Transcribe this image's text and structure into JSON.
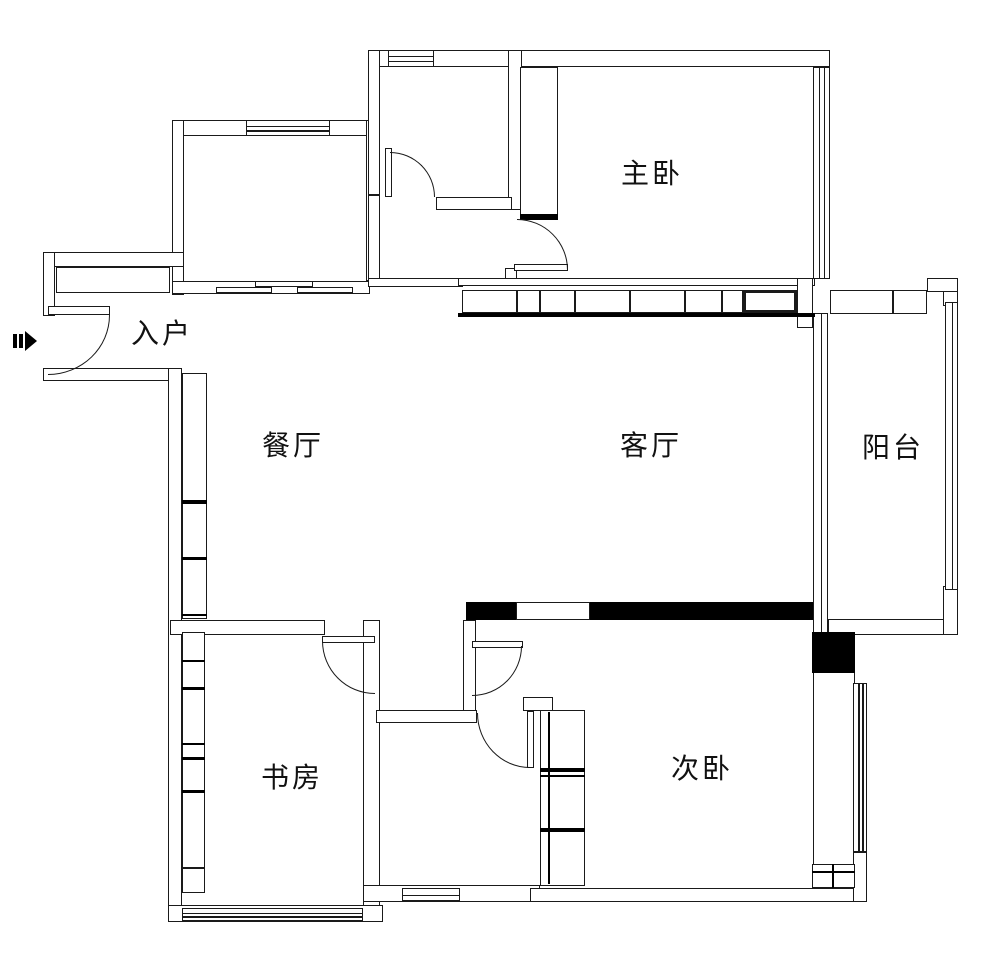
{
  "canvas": {
    "width": 989,
    "height": 970,
    "background_color": "#ffffff",
    "line_color": "#1a1a1a",
    "solid_fill_color": "#000000"
  },
  "rooms": {
    "entry": {
      "label": "入户"
    },
    "master_bedroom": {
      "label": "主卧"
    },
    "dining_room": {
      "label": "餐厅"
    },
    "living_room": {
      "label": "客厅"
    },
    "balcony": {
      "label": "阳台"
    },
    "study": {
      "label": "书房"
    },
    "second_bedroom": {
      "label": "次卧"
    }
  },
  "floorplan": {
    "walls": [
      [
        368,
        50,
        462,
        17
      ],
      [
        172,
        120,
        198,
        16
      ],
      [
        172,
        120,
        12,
        175
      ],
      [
        366,
        120,
        14,
        161
      ],
      [
        172,
        281,
        198,
        13
      ],
      [
        43,
        252,
        141,
        15
      ],
      [
        43,
        252,
        12,
        64
      ],
      [
        43,
        368,
        139,
        13
      ],
      [
        168,
        368,
        14,
        554
      ],
      [
        368,
        50,
        12,
        145
      ],
      [
        368,
        195,
        12,
        86
      ],
      [
        368,
        278,
        95,
        9
      ],
      [
        508,
        50,
        14,
        160
      ],
      [
        436,
        197,
        76,
        13
      ],
      [
        505,
        268,
        12,
        12
      ],
      [
        458,
        278,
        357,
        8
      ],
      [
        797,
        278,
        16,
        50
      ],
      [
        828,
        619,
        130,
        16
      ],
      [
        943,
        282,
        15,
        24
      ],
      [
        943,
        586,
        15,
        49
      ],
      [
        927,
        278,
        31,
        14
      ],
      [
        170,
        620,
        155,
        15
      ],
      [
        363,
        620,
        17,
        302
      ],
      [
        463,
        620,
        13,
        100
      ],
      [
        376,
        710,
        101,
        13
      ],
      [
        523,
        697,
        30,
        14
      ],
      [
        363,
        885,
        177,
        17
      ],
      [
        168,
        905,
        215,
        17
      ],
      [
        530,
        888,
        337,
        14
      ],
      [
        813,
        672,
        42,
        194
      ],
      [
        853,
        852,
        14,
        50
      ],
      [
        56,
        267,
        114,
        26
      ],
      [
        520,
        67,
        38,
        148
      ],
      [
        182,
        373,
        25,
        246
      ],
      [
        182,
        632,
        23,
        236
      ],
      [
        182,
        868,
        23,
        25
      ],
      [
        540,
        710,
        45,
        176
      ],
      [
        812,
        864,
        43,
        24
      ],
      [
        255,
        281,
        58,
        6
      ],
      [
        216,
        287,
        56,
        6
      ],
      [
        297,
        287,
        56,
        6
      ]
    ],
    "solids": [
      [
        466,
        602,
        50,
        18
      ],
      [
        590,
        602,
        223,
        18
      ],
      [
        812,
        632,
        43,
        41
      ],
      [
        520,
        214,
        38,
        6
      ],
      [
        458,
        313,
        357,
        4
      ],
      [
        182,
        500,
        25,
        4
      ],
      [
        182,
        557,
        25,
        3
      ],
      [
        182,
        614,
        25,
        2
      ],
      [
        182,
        660,
        23,
        2
      ],
      [
        182,
        687,
        23,
        3
      ],
      [
        182,
        743,
        23,
        2
      ],
      [
        182,
        757,
        23,
        3
      ],
      [
        182,
        790,
        23,
        3
      ],
      [
        540,
        768,
        45,
        4
      ],
      [
        540,
        775,
        45,
        2
      ],
      [
        540,
        828,
        45,
        4
      ],
      [
        548,
        712,
        2,
        172
      ],
      [
        832,
        864,
        2,
        24
      ],
      [
        812,
        871,
        43,
        2
      ]
    ],
    "windows": [
      [
        388,
        50,
        46,
        17,
        "h",
        2,
        0
      ],
      [
        246,
        120,
        84,
        16,
        "h",
        2,
        0
      ],
      [
        813,
        67,
        17,
        212,
        "v",
        2,
        0
      ],
      [
        462,
        290,
        55,
        23,
        "h",
        0,
        0
      ],
      [
        517,
        290,
        23,
        23,
        "h",
        0,
        0
      ],
      [
        540,
        290,
        35,
        23,
        "h",
        0,
        0
      ],
      [
        575,
        290,
        55,
        23,
        "h",
        0,
        0
      ],
      [
        630,
        290,
        55,
        23,
        "h",
        0,
        0
      ],
      [
        685,
        290,
        37,
        23,
        "h",
        0,
        0
      ],
      [
        722,
        290,
        21,
        23,
        "h",
        0,
        0
      ],
      [
        743,
        290,
        54,
        23,
        "h",
        0,
        1
      ],
      [
        830,
        290,
        63,
        24,
        "h",
        0,
        0
      ],
      [
        893,
        290,
        34,
        24,
        "h",
        0,
        0
      ],
      [
        945,
        302,
        13,
        288,
        "v",
        1,
        0
      ],
      [
        853,
        683,
        14,
        169,
        "v",
        2,
        0
      ],
      [
        516,
        602,
        74,
        18,
        "h",
        0,
        0
      ],
      [
        402,
        888,
        58,
        13,
        "h",
        1,
        0
      ],
      [
        182,
        908,
        181,
        13,
        "h",
        2,
        0
      ],
      [
        813,
        313,
        15,
        320,
        "v",
        1,
        0
      ]
    ],
    "doors": [
      {
        "name": "entry-door",
        "leaf": [
          48,
          306,
          62,
          9
        ],
        "arc": [
          48,
          315,
          62,
          60
        ],
        "corner": "br"
      },
      {
        "name": "top-bath-door",
        "leaf": [
          385,
          148,
          7,
          49
        ],
        "arc": [
          390,
          152,
          45,
          45
        ],
        "corner": "tr"
      },
      {
        "name": "master-bedroom-door",
        "leaf": [
          514,
          264,
          54,
          7
        ],
        "arc": [
          517,
          219,
          51,
          51
        ],
        "corner": "tr"
      },
      {
        "name": "study-door",
        "leaf": [
          322,
          636,
          53,
          7
        ],
        "arc": [
          322,
          641,
          53,
          53
        ],
        "corner": "bl"
      },
      {
        "name": "hall-door",
        "leaf": [
          472,
          641,
          51,
          7
        ],
        "arc": [
          472,
          646,
          50,
          50
        ],
        "corner": "br"
      },
      {
        "name": "bathroom-door",
        "leaf": [
          527,
          711,
          7,
          57
        ],
        "arc": [
          477,
          713,
          53,
          55
        ],
        "corner": "bl"
      }
    ]
  }
}
